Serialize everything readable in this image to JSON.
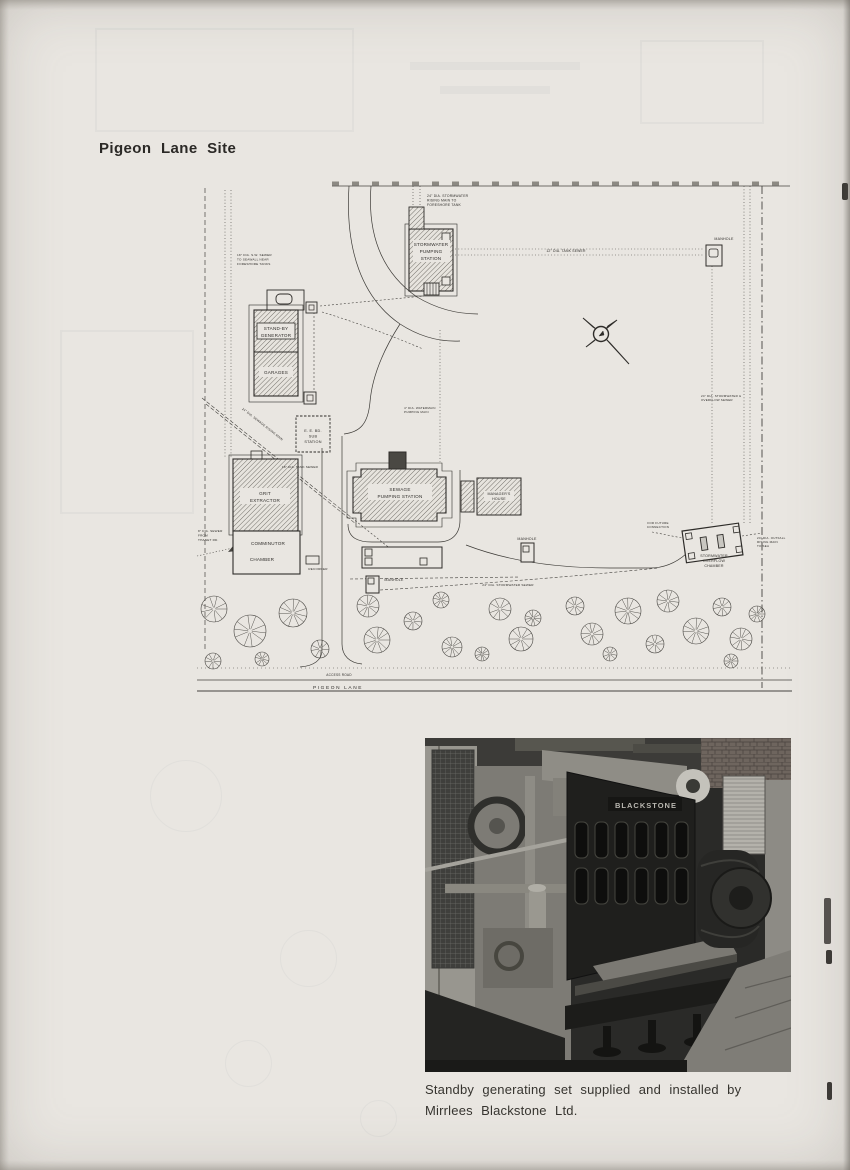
{
  "page": {
    "title": "Pigeon Lane Site"
  },
  "caption": {
    "line1": "Standby generating set supplied and installed by",
    "line2": "Mirrlees Blackstone Ltd."
  },
  "photo": {
    "brand": "BLACKSTONE"
  },
  "plan": {
    "labels": [
      {
        "t": "24\" DIA. STORMWATER",
        "x": 427,
        "y": 197,
        "s": 3.4,
        "a": "start"
      },
      {
        "t": "RISING MAIN TO",
        "x": 427,
        "y": 201.5,
        "s": 3.4,
        "a": "start"
      },
      {
        "t": "FORESHORE TANK",
        "x": 427,
        "y": 206,
        "s": 3.4,
        "a": "start"
      },
      {
        "t": "STORMWATER",
        "x": 431,
        "y": 246,
        "s": 4.6
      },
      {
        "t": "PUMPING",
        "x": 431,
        "y": 253,
        "s": 4.6
      },
      {
        "t": "STATION",
        "x": 431,
        "y": 260,
        "s": 4.6
      },
      {
        "t": "12\" DIA. TANK SEWER",
        "x": 566,
        "y": 252,
        "s": 3.4
      },
      {
        "t": "MANHOLE",
        "x": 724,
        "y": 240,
        "s": 3.6
      },
      {
        "t": "18\" DIA. S.W. SEWER",
        "x": 237,
        "y": 256,
        "s": 3.1,
        "a": "start"
      },
      {
        "t": "TO SEAWALL NEAR",
        "x": 237,
        "y": 260.5,
        "s": 3.1,
        "a": "start"
      },
      {
        "t": "FORESHORE TANKS",
        "x": 237,
        "y": 265,
        "s": 3.1,
        "a": "start"
      },
      {
        "t": "STAND-BY",
        "x": 276,
        "y": 330,
        "s": 4.6
      },
      {
        "t": "GENERATOR",
        "x": 276,
        "y": 337,
        "s": 4.6
      },
      {
        "t": "GARAGES",
        "x": 276,
        "y": 374,
        "s": 4.6
      },
      {
        "t": "E. E. BD.",
        "x": 313,
        "y": 432,
        "s": 3.8
      },
      {
        "t": "SUB",
        "x": 313,
        "y": 437.5,
        "s": 3.8
      },
      {
        "t": "STATION",
        "x": 313,
        "y": 443,
        "s": 3.8
      },
      {
        "t": "24\" DIA. SEWAGE RISING MAIN",
        "x": 262,
        "y": 425,
        "s": 3.1,
        "r": 38
      },
      {
        "t": "18\" DIA. TANK SEWER",
        "x": 300,
        "y": 468,
        "s": 3.1
      },
      {
        "t": "GRIT",
        "x": 265,
        "y": 495,
        "s": 4.6
      },
      {
        "t": "EXTRACTOR",
        "x": 265,
        "y": 502,
        "s": 4.6
      },
      {
        "t": "COMMINUTOR",
        "x": 268,
        "y": 545,
        "s": 4.6
      },
      {
        "t": "CHAMBER",
        "x": 262,
        "y": 561,
        "s": 4.6
      },
      {
        "t": "8\" DIA. SEWER",
        "x": 198,
        "y": 532,
        "s": 3.1,
        "a": "start"
      },
      {
        "t": "FROM",
        "x": 198,
        "y": 536.5,
        "s": 3.1,
        "a": "start"
      },
      {
        "t": "THANET RD.",
        "x": 198,
        "y": 541,
        "s": 3.1,
        "a": "start"
      },
      {
        "t": "RECORDER",
        "x": 318,
        "y": 570,
        "s": 3.1
      },
      {
        "t": "SEWAGE",
        "x": 400,
        "y": 491,
        "s": 4.6
      },
      {
        "t": "PUMPING  STATION",
        "x": 400,
        "y": 498,
        "s": 4.6
      },
      {
        "t": "MANAGER'S",
        "x": 499,
        "y": 495,
        "s": 3.6
      },
      {
        "t": "HOUSE",
        "x": 499,
        "y": 500,
        "s": 3.6
      },
      {
        "t": "MANHOLE",
        "x": 527,
        "y": 540,
        "s": 3.6
      },
      {
        "t": "MANHOLE",
        "x": 394,
        "y": 581,
        "s": 3.6
      },
      {
        "t": "24\" DIA. STORMWATER SEWER",
        "x": 508,
        "y": 586,
        "s": 3.1
      },
      {
        "t": "STORMWATER",
        "x": 714,
        "y": 557,
        "s": 3.6
      },
      {
        "t": "OVERFLOW",
        "x": 714,
        "y": 562,
        "s": 3.6
      },
      {
        "t": "CHAMBER",
        "x": 714,
        "y": 567,
        "s": 3.6
      },
      {
        "t": "FOR FUTURE",
        "x": 658,
        "y": 524,
        "s": 3
      },
      {
        "t": "CONNECTION",
        "x": 658,
        "y": 528,
        "s": 3
      },
      {
        "t": "24\" DIA. OUTFALL",
        "x": 757,
        "y": 539,
        "s": 3,
        "a": "start"
      },
      {
        "t": "RISING MAIN",
        "x": 757,
        "y": 543,
        "s": 3,
        "a": "start"
      },
      {
        "t": "TO SEA",
        "x": 757,
        "y": 547,
        "s": 3,
        "a": "start"
      },
      {
        "t": "24\" DIA. STORMWATER &",
        "x": 701,
        "y": 397,
        "s": 3,
        "a": "start"
      },
      {
        "t": "OVERFLOW SEWER",
        "x": 701,
        "y": 401,
        "s": 3,
        "a": "start"
      },
      {
        "t": "4\" DIA. WATERMAIN",
        "x": 404,
        "y": 409,
        "s": 3,
        "a": "start"
      },
      {
        "t": "PUMPING MAIN",
        "x": 404,
        "y": 413,
        "s": 3,
        "a": "start"
      },
      {
        "t": "ACCESS  ROAD",
        "x": 339,
        "y": 676,
        "s": 3.2
      },
      {
        "t": "PIGEON  LANE",
        "x": 338,
        "y": 689,
        "s": 4.8,
        "ls": 1.6
      }
    ],
    "trees": [
      {
        "x": 214,
        "y": 609,
        "r": 13
      },
      {
        "x": 250,
        "y": 631,
        "r": 16
      },
      {
        "x": 293,
        "y": 613,
        "r": 14
      },
      {
        "x": 320,
        "y": 649,
        "r": 9
      },
      {
        "x": 368,
        "y": 606,
        "r": 11
      },
      {
        "x": 377,
        "y": 640,
        "r": 13
      },
      {
        "x": 413,
        "y": 621,
        "r": 9
      },
      {
        "x": 441,
        "y": 600,
        "r": 8
      },
      {
        "x": 452,
        "y": 647,
        "r": 10
      },
      {
        "x": 500,
        "y": 609,
        "r": 11
      },
      {
        "x": 521,
        "y": 639,
        "r": 12
      },
      {
        "x": 533,
        "y": 618,
        "r": 8
      },
      {
        "x": 575,
        "y": 606,
        "r": 9
      },
      {
        "x": 592,
        "y": 634,
        "r": 11
      },
      {
        "x": 628,
        "y": 611,
        "r": 13
      },
      {
        "x": 655,
        "y": 644,
        "r": 9
      },
      {
        "x": 668,
        "y": 601,
        "r": 11
      },
      {
        "x": 696,
        "y": 631,
        "r": 13
      },
      {
        "x": 722,
        "y": 607,
        "r": 9
      },
      {
        "x": 741,
        "y": 639,
        "r": 11
      },
      {
        "x": 757,
        "y": 614,
        "r": 8
      },
      {
        "x": 213,
        "y": 661,
        "r": 8
      },
      {
        "x": 262,
        "y": 659,
        "r": 7
      },
      {
        "x": 482,
        "y": 654,
        "r": 7
      },
      {
        "x": 610,
        "y": 654,
        "r": 7
      },
      {
        "x": 731,
        "y": 661,
        "r": 7
      }
    ]
  }
}
